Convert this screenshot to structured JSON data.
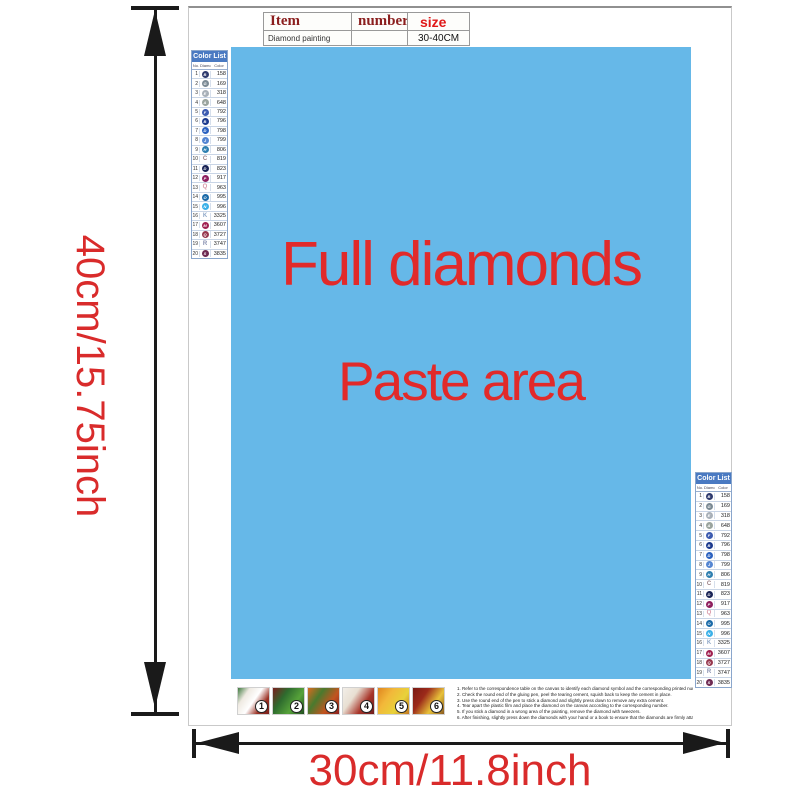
{
  "colors": {
    "blue": "#66b8e8",
    "red": "#d92b2b",
    "text-red": "#e12a2a",
    "hdr-darkred": "#8b1e1e",
    "hdr-red": "#e01818",
    "list-hdr": "#4a7ac2",
    "arrow": "#1a1a1a"
  },
  "item_table": {
    "headers": {
      "item": "Item",
      "number": "number",
      "size": "size"
    },
    "row": {
      "item": "Diamond painting",
      "number": "",
      "size": "30-40CM"
    }
  },
  "paste_area": {
    "line1": "Full diamonds",
    "line2": "Paste area"
  },
  "dimensions": {
    "height_label": "40cm/15.75inch",
    "width_label": "30cm/11.8inch"
  },
  "color_list": {
    "title": "Color List",
    "columns": {
      "no": "No.",
      "symbol": "Diamond",
      "color": "Color"
    },
    "rows": [
      {
        "no": "1",
        "symbol": "B",
        "code": "158",
        "circle": true,
        "swatch": "#2e3a6e"
      },
      {
        "no": "2",
        "symbol": "G",
        "code": "169",
        "circle": true,
        "swatch": "#7b8a94"
      },
      {
        "no": "3",
        "symbol": "E",
        "code": "318",
        "circle": true,
        "swatch": "#a8b0b8"
      },
      {
        "no": "4",
        "symbol": "A",
        "code": "648",
        "circle": true,
        "swatch": "#9aa49e"
      },
      {
        "no": "5",
        "symbol": "F",
        "code": "792",
        "circle": true,
        "swatch": "#3c5bb0"
      },
      {
        "no": "6",
        "symbol": "B",
        "code": "796",
        "circle": true,
        "swatch": "#1c3a8e"
      },
      {
        "no": "7",
        "symbol": "D",
        "code": "798",
        "circle": true,
        "swatch": "#2c62c0"
      },
      {
        "no": "8",
        "symbol": "J",
        "code": "799",
        "circle": true,
        "swatch": "#5586d2"
      },
      {
        "no": "9",
        "symbol": "H",
        "code": "806",
        "circle": true,
        "swatch": "#2e7fb0"
      },
      {
        "no": "10",
        "symbol": "C",
        "code": "819",
        "circle": false,
        "swatch": "#9a7e84"
      },
      {
        "no": "11",
        "symbol": "D",
        "code": "823",
        "circle": true,
        "swatch": "#1a2456"
      },
      {
        "no": "12",
        "symbol": "P",
        "code": "917",
        "circle": true,
        "swatch": "#8e1f5e"
      },
      {
        "no": "13",
        "symbol": "Q",
        "code": "963",
        "circle": false,
        "swatch": "#d898a8"
      },
      {
        "no": "14",
        "symbol": "O",
        "code": "995",
        "circle": true,
        "swatch": "#1a6aa8"
      },
      {
        "no": "15",
        "symbol": "N",
        "code": "996",
        "circle": true,
        "swatch": "#3ab0e8"
      },
      {
        "no": "16",
        "symbol": "K",
        "code": "3325",
        "circle": false,
        "swatch": "#8fa8c8"
      },
      {
        "no": "17",
        "symbol": "M",
        "code": "3607",
        "circle": true,
        "swatch": "#a02050"
      },
      {
        "no": "18",
        "symbol": "Q",
        "code": "3727",
        "circle": true,
        "swatch": "#96374e"
      },
      {
        "no": "19",
        "symbol": "R",
        "code": "3747",
        "circle": false,
        "swatch": "#8890b0"
      },
      {
        "no": "20",
        "symbol": "S",
        "code": "3835",
        "circle": true,
        "swatch": "#6e2a52"
      }
    ]
  },
  "thumbnails": [
    {
      "number": "1",
      "colors": [
        "#3f7a3f",
        "#efeae2",
        "#ffffff",
        "#9c3326",
        "#7a1f1a"
      ]
    },
    {
      "number": "2",
      "colors": [
        "#7a1f1f",
        "#2e6b2e",
        "#57a33a",
        "#1f4d1f"
      ]
    },
    {
      "number": "3",
      "colors": [
        "#d96a1f",
        "#497a2e",
        "#c2541f",
        "#8a1f1f"
      ]
    },
    {
      "number": "4",
      "colors": [
        "#f2eee8",
        "#e8dfd2",
        "#a8352a",
        "#6e1c1c"
      ]
    },
    {
      "number": "5",
      "colors": [
        "#e0861f",
        "#f2b83a",
        "#e8d23a",
        "#c2761f"
      ]
    },
    {
      "number": "6",
      "colors": [
        "#7a1a14",
        "#9c2a1a",
        "#e8c23a",
        "#8a5a1f"
      ]
    }
  ],
  "instructions": [
    "1. Refer to the correspondence table on the canvas to identify each diamond symbol and the corresponding printed number on the canvas.",
    "2. Check the round end of the gluing pen, peel the tearing cement, squish back to keep the cement in place.",
    "3. Use the round end of the pen to stick a diamond and slightly press down to remove any extra cement.",
    "4. Tear apart the plastic film and place the diamond on the canvas according to the corresponding number.",
    "5. If you stick a diamond in a wrong area of the painting, remove the diamond with tweezers.",
    "6. After finishing, slightly press down the diamonds with your hand or a book to ensure that the diamonds are firmly attached."
  ]
}
